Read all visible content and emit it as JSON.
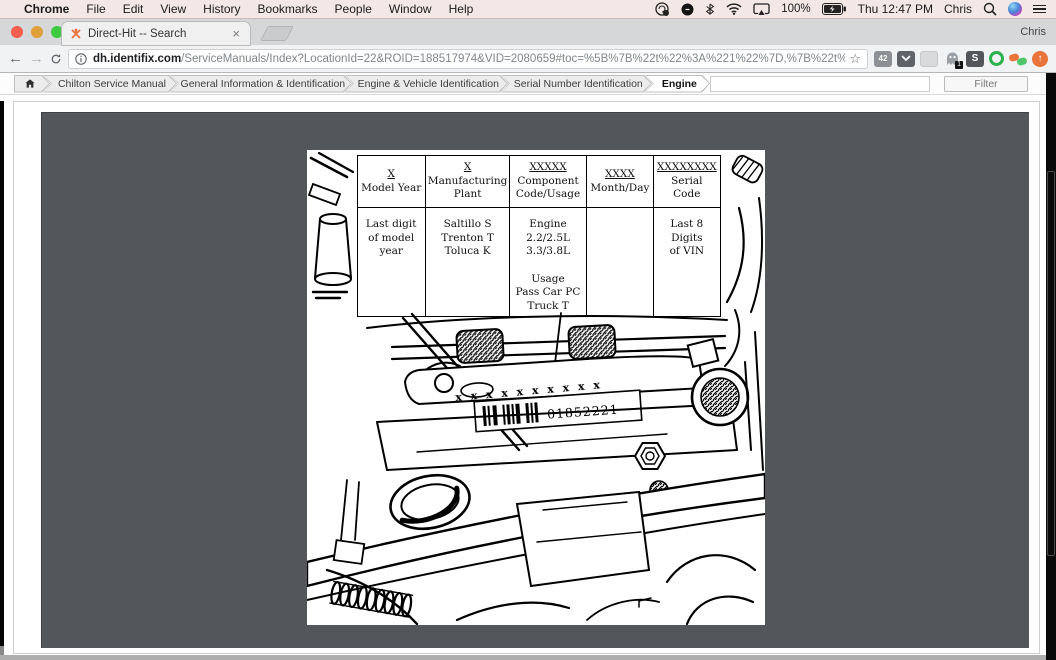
{
  "colors": {
    "accent_orange": "#e8743b",
    "panel_gray": "#54575a",
    "menubar_tint": "#f4e8e7",
    "scrollbar_black": "#0a0a0a",
    "traffic_red": "#f55d4e",
    "traffic_yellow": "#dfa03b",
    "traffic_green": "#3ec943"
  },
  "menubar": {
    "apple": "",
    "items": [
      "Chrome",
      "File",
      "Edit",
      "View",
      "History",
      "Bookmarks",
      "People",
      "Window",
      "Help"
    ],
    "battery": "100%",
    "clock": "Thu 12:47 PM",
    "user": "Chris"
  },
  "tabbar": {
    "tab_title": "Direct-Hit -- Search",
    "profile": "Chris"
  },
  "glyphs": {
    "close_tab": "×",
    "star": "☆",
    "back": "←",
    "forward": "→",
    "info": "ⓘ",
    "arrow_up": "↑"
  },
  "urlbar": {
    "domain": "dh.identifix.com",
    "path": "/ServiceManuals/Index?LocationId=22&ROID=188517974&VID=2080659#toc=%5B%7B%22t%22%3A%221%22%7D,%7B%22t%22%3A%222%22,%...",
    "ext_badge_42": "42",
    "ghost_badge": "1",
    "ext_s": "S"
  },
  "breadcrumbs": {
    "items": [
      "Chilton Service Manual",
      "General Information & Identification",
      "Engine & Vehicle Identification",
      "Serial Number Identification",
      "Engine"
    ],
    "filter_placeholder": "",
    "filter_button": "Filter"
  },
  "figure": {
    "table": {
      "headers": [
        {
          "code": "X",
          "label": "Model Year"
        },
        {
          "code": "X",
          "label": "Manufacturing Plant"
        },
        {
          "code": "XXXXX",
          "label": "Component Code/Usage"
        },
        {
          "code": "XXXX",
          "label": "Month/Day"
        },
        {
          "code": "XXXXXXXX",
          "label": "Serial Code"
        }
      ],
      "cells": [
        "Last digit\nof model\nyear",
        "Saltillo S\nTrenton T\nToluca K",
        "Engine\n2.2/2.5L\n3.3/3.8L\n\nUsage\nPass Car PC\nTruck T",
        "",
        "Last 8 Digits\nof VIN"
      ]
    },
    "label_xrow": "x x x   x x x x x x   x",
    "serial_number": "01852221"
  }
}
